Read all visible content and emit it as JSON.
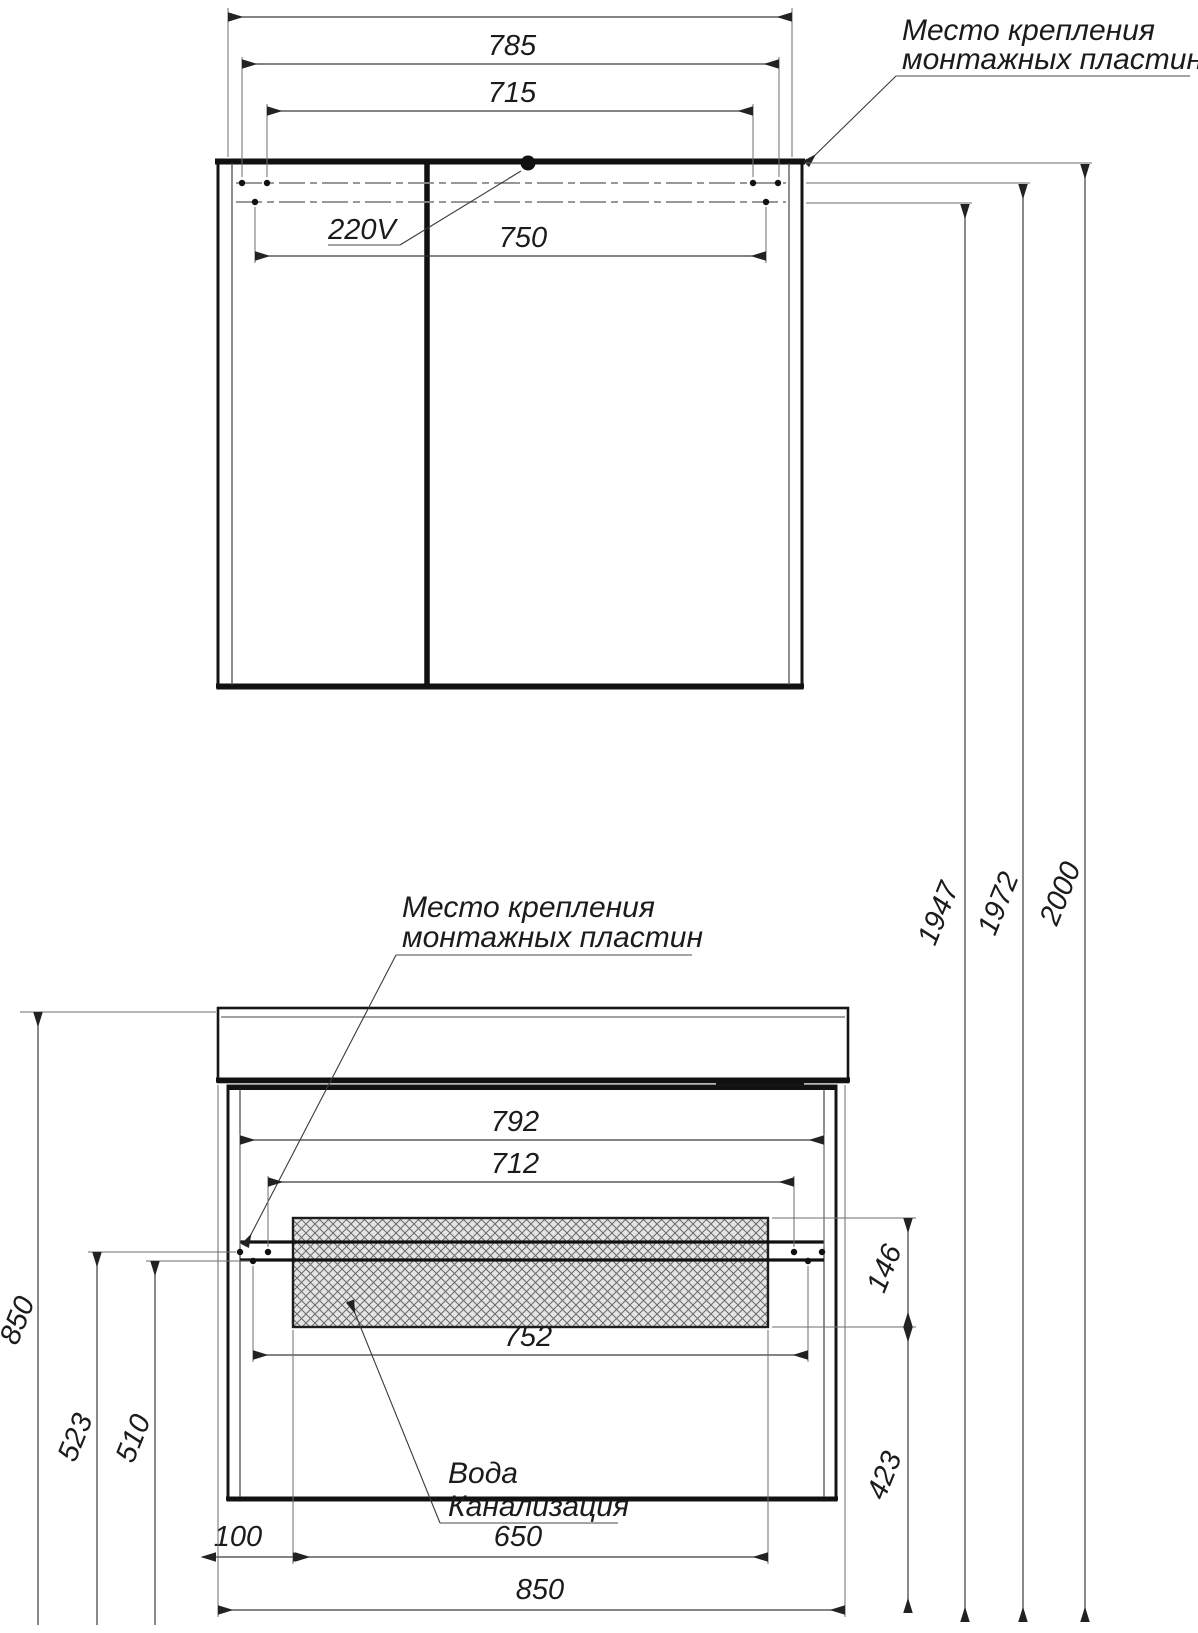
{
  "colors": {
    "paper": "#ffffff",
    "ink": "#141414",
    "dimension": "#3a3a3a",
    "hatch_bg": "#e4e4e4",
    "hatch_line": "#6a6a6a"
  },
  "annotations": {
    "mounting_plates_top": {
      "line1": "Место крепления",
      "line2": "монтажных пластин"
    },
    "mounting_plates_bottom": {
      "line1": "Место крепления",
      "line2": "монтажных пластин"
    },
    "power": "220V",
    "water": "Вода",
    "sewer": "Канализация"
  },
  "top_view": {
    "dims": {
      "d785": "785",
      "d715": "715",
      "d750": "750"
    }
  },
  "bottom_view": {
    "dims": {
      "d792": "792",
      "d712": "712",
      "d752": "752",
      "d100": "100",
      "d650": "650",
      "d850_width": "850",
      "d146": "146",
      "d423": "423",
      "d850_height": "850",
      "d523": "523",
      "d510": "510"
    }
  },
  "heights": {
    "d1947": "1947",
    "d1972": "1972",
    "d2000": "2000"
  }
}
